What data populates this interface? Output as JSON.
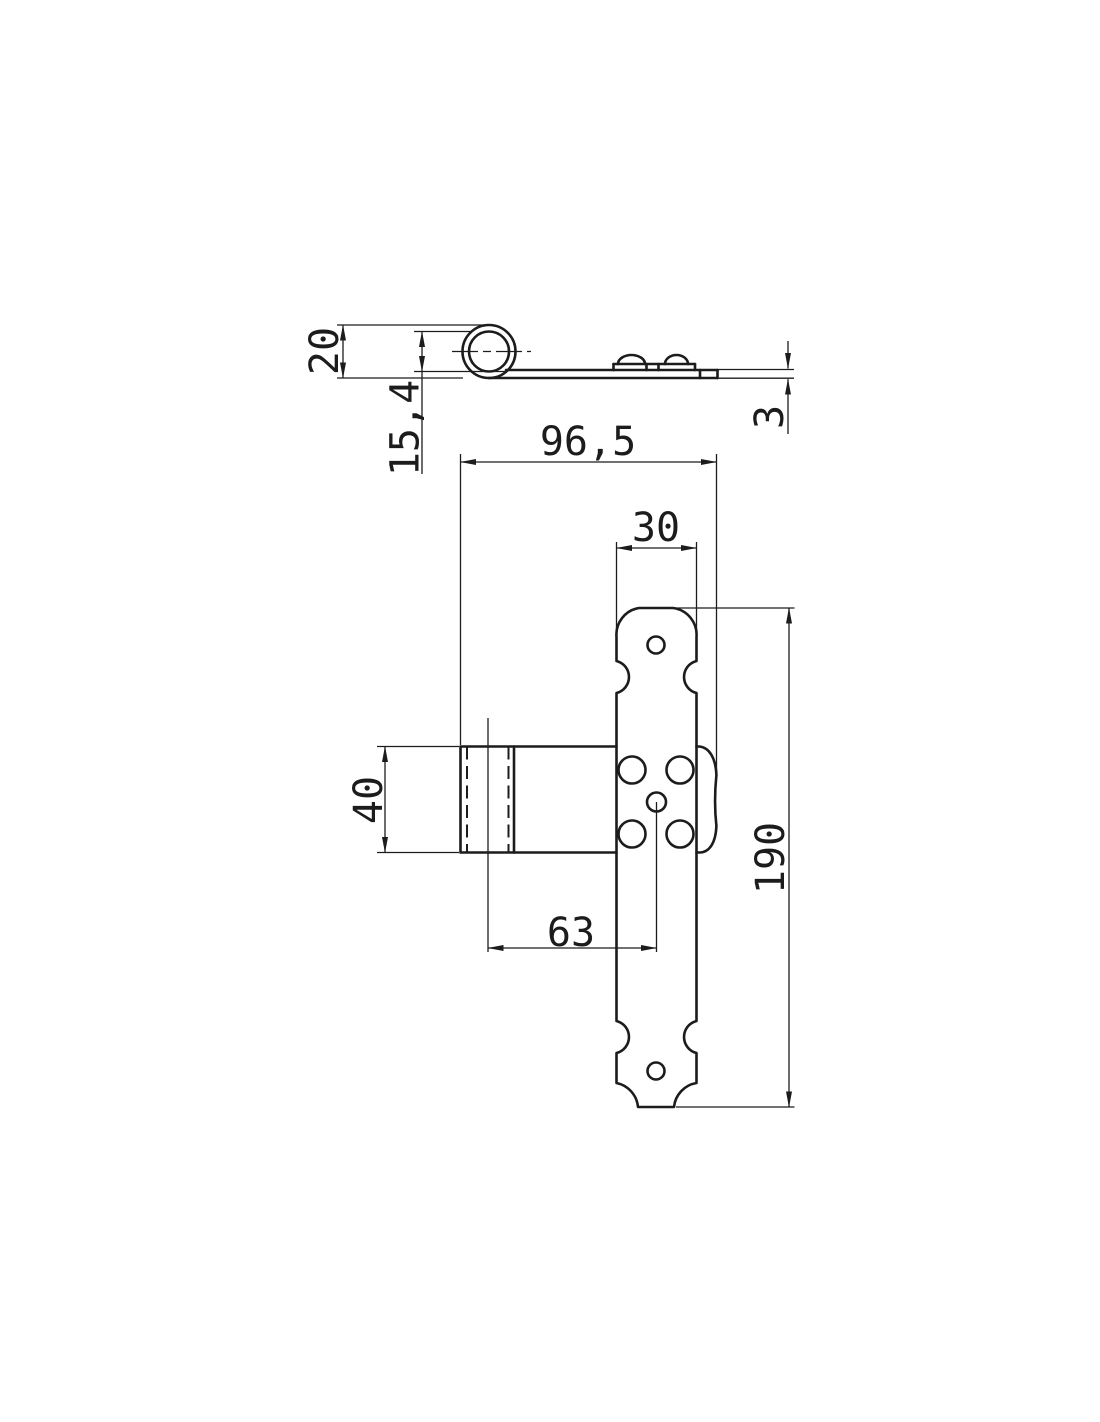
{
  "drawing": {
    "component": "Ornamental T-hinge orthographic technical drawing",
    "background_color": "#ffffff",
    "line_color": "#1c1c1c",
    "views": {
      "side": "profile view with rolled knuckle and embossed screw domes",
      "front": "front view with decorative strap, sleeve and screw holes"
    },
    "dimensions": {
      "knuckle_diameter": "20",
      "knuckle_bore": "15,4",
      "material_thickness": "3",
      "overall_width": "96,5",
      "strap_width": "30",
      "wing_height": "40",
      "axis_to_hole": "63",
      "strap_length": "190"
    }
  }
}
